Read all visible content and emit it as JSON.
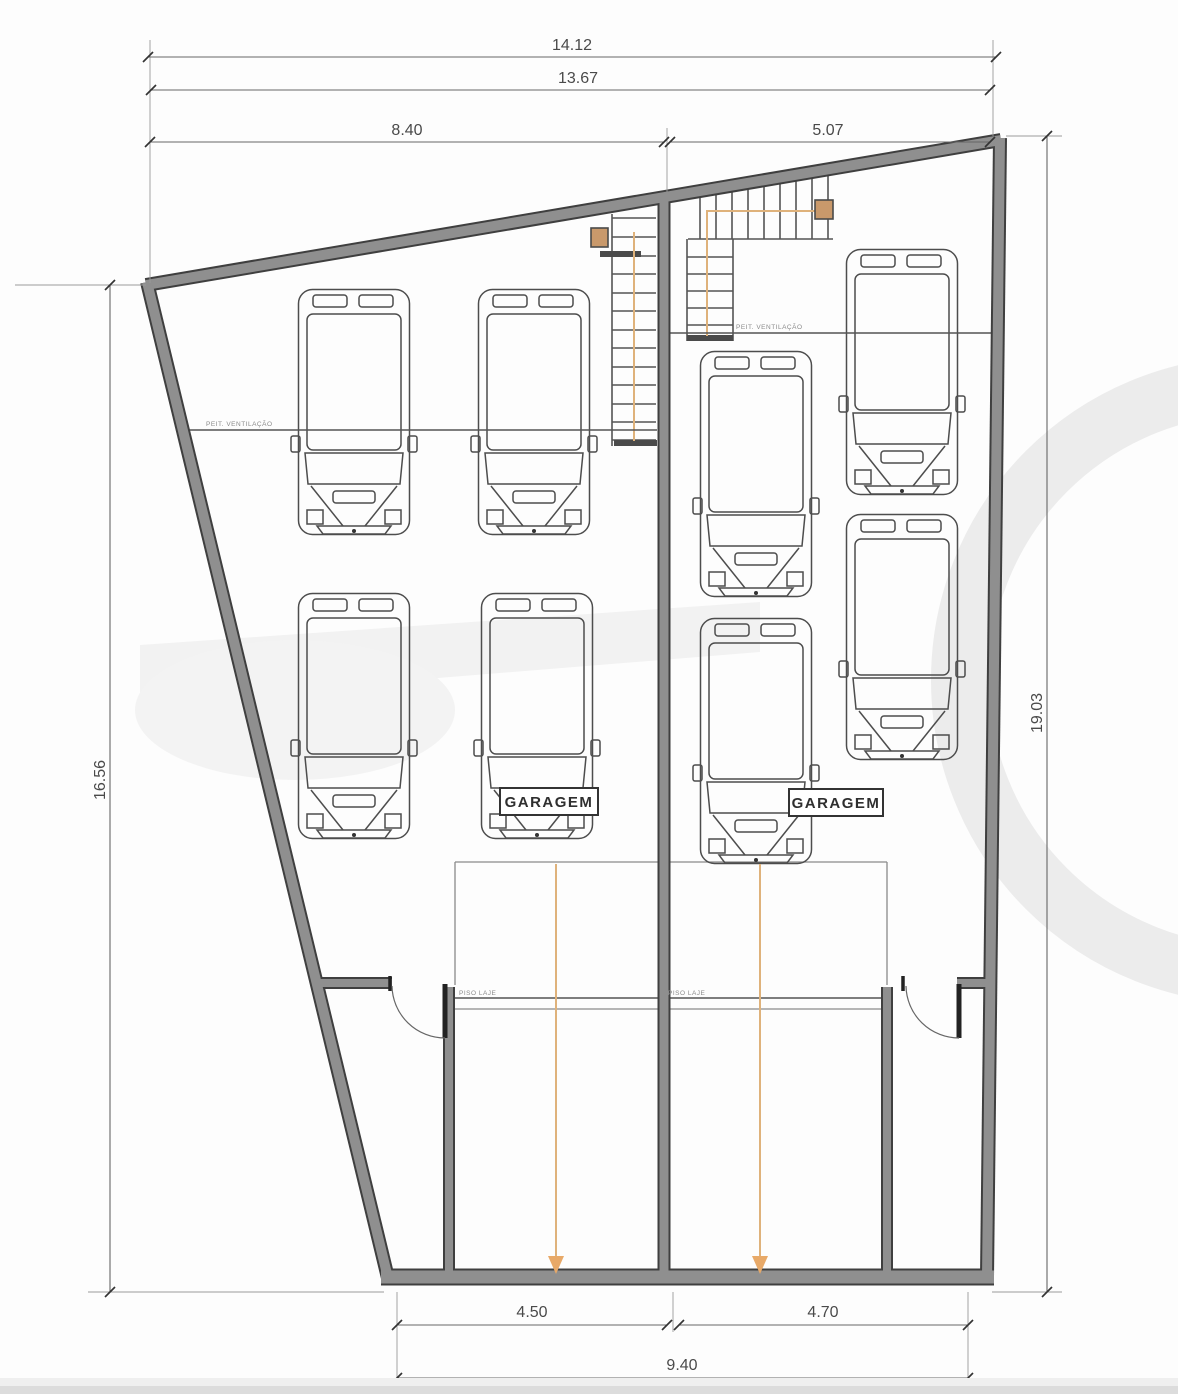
{
  "drawing": {
    "type": "garage-floor-plan",
    "dimensions": {
      "overall_width": "14.12",
      "inner_width": "13.67",
      "left_bay_width": "8.40",
      "right_bay_width": "5.07",
      "left_side_depth": "16.56",
      "right_side_depth": "19.03",
      "bottom_left_bay": "4.50",
      "bottom_right_bay": "4.70",
      "bottom_total": "9.40"
    },
    "labels": {
      "garagem": "GARAGEM",
      "ventilation": "PEIT. VENTILAÇÃO",
      "floor": "PISO LAJE"
    },
    "parking": {
      "car_count": 8,
      "left_garage_cars": 4,
      "right_garage_cars": 4
    },
    "colors": {
      "wall_fill": "#8f8f8f",
      "wall_edge": "#3f3f3f",
      "thin_line": "#8a8a8a",
      "drive_path_orange": "#dfb27b",
      "stair_marker_fill": "#c9996b",
      "dimension_text": "#4a4a4a"
    }
  }
}
